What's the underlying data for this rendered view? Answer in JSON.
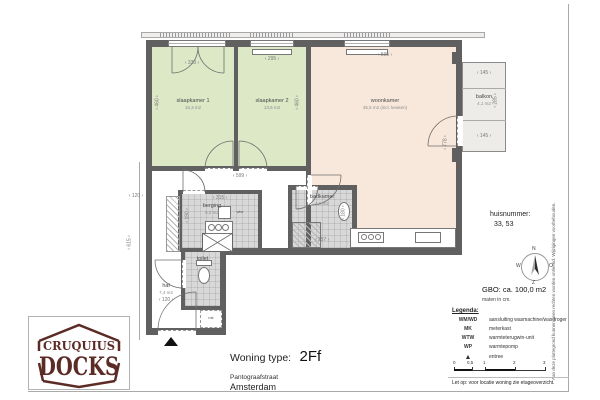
{
  "plan": {
    "rooms": {
      "slaapkamer1": {
        "name": "slaapkamer 1",
        "area": "15,3 m2"
      },
      "slaapkamer2": {
        "name": "slaapkamer 2",
        "area": "13,6 m2"
      },
      "woonkamer": {
        "name": "woonkamer",
        "area": "45,5 m2 (incl. keuken)"
      },
      "balkon": {
        "name": "balkon",
        "area": "4,1 m2"
      },
      "berging": {
        "name": "berging",
        "area": "6,0 m2"
      },
      "badkamer": {
        "name": "badkamer",
        "area": "4,6 m2"
      },
      "toilet": {
        "name": "toilet"
      },
      "hal": {
        "name": "hal",
        "area": "7,4 m2"
      }
    },
    "markers": {
      "wtw": "wtw",
      "mk": "mk"
    },
    "dims": {
      "sk1_w": "333",
      "sk2_w": "295",
      "wk_w": "595",
      "sk1_h": "460",
      "sk2_h": "460",
      "wk_h": "778",
      "balkon_t": "145",
      "balkon_b": "145",
      "balkon_r": "285",
      "hall_top": "599",
      "berging_w": "315",
      "berging_h": "190",
      "badkamer_w": "257",
      "badkamer_h": "180",
      "hal_w": "120",
      "left_small": "120",
      "left_v": "615"
    }
  },
  "compass": {
    "n": "N",
    "e": "O",
    "s": "Z",
    "w": "W"
  },
  "info": {
    "huisnummer_label": "huisnummer:",
    "huisnummer_value": "33, 53",
    "gbo": "GBO: ca. 100,0 m2",
    "maten": "maten in cm."
  },
  "legend": {
    "title": "Legenda:",
    "items": [
      {
        "abbr": "WM/WD",
        "desc": "aansluiting wasmachine/wasdroger"
      },
      {
        "abbr": "MK",
        "desc": "meterkast"
      },
      {
        "abbr": "WTW",
        "desc": "warmteterugwin-unit"
      },
      {
        "abbr": "WP",
        "desc": "warmtepomp"
      },
      {
        "abbr": "▲",
        "desc": "entree"
      }
    ],
    "scale_ticks": [
      "0",
      "0,5",
      "1",
      "2",
      "3"
    ],
    "note": "Let op:  voor locatie woning zie etageoverzicht."
  },
  "titleblock": {
    "label": "Woning type:",
    "value": "2Ff",
    "street": "Pantograafstraat",
    "city": "Amsterdam"
  },
  "logo": {
    "line1": "CRUQUIUS",
    "line2": "DOCKS"
  },
  "disclaimer": "Aan deze plattegrond kunnen geen rechten worden ontleend. Wijzigingen voorbehouden.",
  "colors": {
    "wall": "#606060",
    "bedroom": "#dce8c6",
    "living": "#f8e8db",
    "tile": "#d8d8d8",
    "logo": "#5c2b26"
  }
}
